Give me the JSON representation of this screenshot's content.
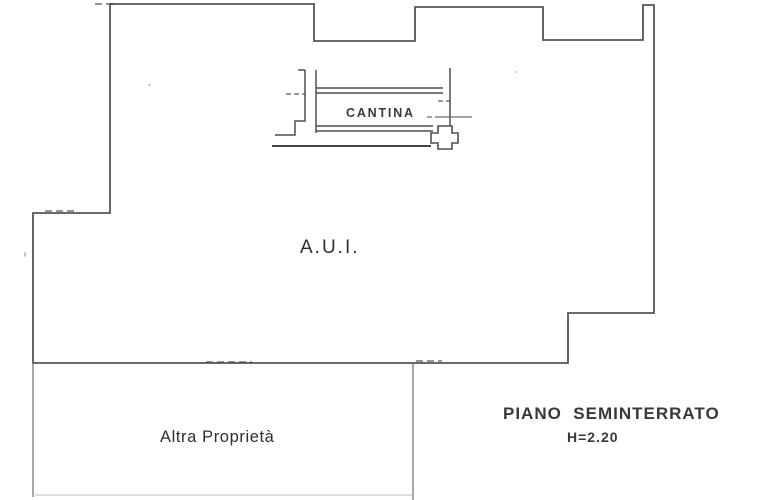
{
  "labels": {
    "cantina": "CANTINA",
    "aui": "A.U.I.",
    "altra_proprieta": "Altra Proprietà",
    "piano_seminterrato": "PIANO  SEMINTERRATO",
    "height": "H=2.20"
  },
  "colors": {
    "background": "#ffffff",
    "wall_line": "#4f4f4f",
    "light_line": "#6e6e6e",
    "faint_line": "#bdbdbd",
    "text": "#333333"
  },
  "paths": {
    "main_outline": "110,4 314,4 314,41 415,41 415,7 543,7 543,40 643,40 643,5 654,5 654,313 568,313 568,363 33,363 33,213 110,213",
    "stair": "M298,70 L305,70 M305,70 L305,121 L295,121 L295,135 L275,135",
    "stair_dash": "M286,94 L306,94",
    "room_left_wall": "M316,70 L316,133",
    "room_top_wall": "M316,88 L443,88 M316,93 L443,93",
    "room_right_wall": "M450,68 L450,131",
    "door_dash": "M438,101 L452,101",
    "door_line": "M427,117 L432,117 M435,117 L472,117",
    "room_bottom_wall": "M316,126 L433,126 M316,131 L433,131",
    "column": "M438,126 L452,126 L452,133 L458,133 L458,143 L452,143 L452,149 L438,149 L438,143 L431,143 L431,133 L438,133 Z",
    "bottom_long_line": "M272,146 L431,146",
    "divider_line": "M413,363 L413,500",
    "left_lower_wall": "M33,363 L33,497",
    "bottom_faint_line": "M35,495 L413,495",
    "deco_dashes": "M95,4 L113,4 M45,211 L78,211 M416,361 L442,361 M206,362 L252,362"
  }
}
